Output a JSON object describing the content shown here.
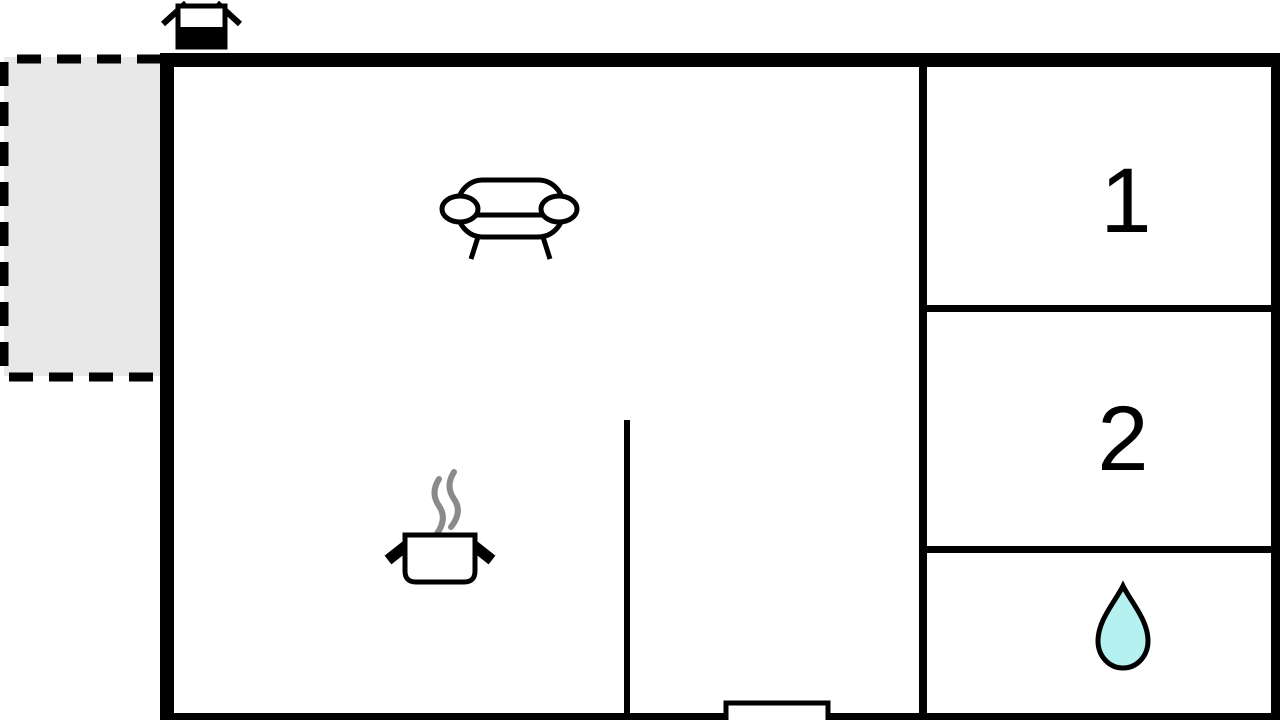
{
  "page": {
    "title": "Holiday home floor plan"
  },
  "rooms": {
    "room1_label": "1",
    "room2_label": "2"
  },
  "icons": {
    "chimney": "chimney-icon",
    "sofa": "sofa-icon",
    "cooking_pot": "cooking-pot-icon",
    "steam": "steam-icon",
    "water_drop": "water-drop-icon"
  },
  "colors": {
    "wall": "#000000",
    "background": "#ffffff",
    "terrace_fill": "#e8e8e8",
    "steam": "#8a8a8a",
    "drop_fill": "#b5f1f1"
  }
}
